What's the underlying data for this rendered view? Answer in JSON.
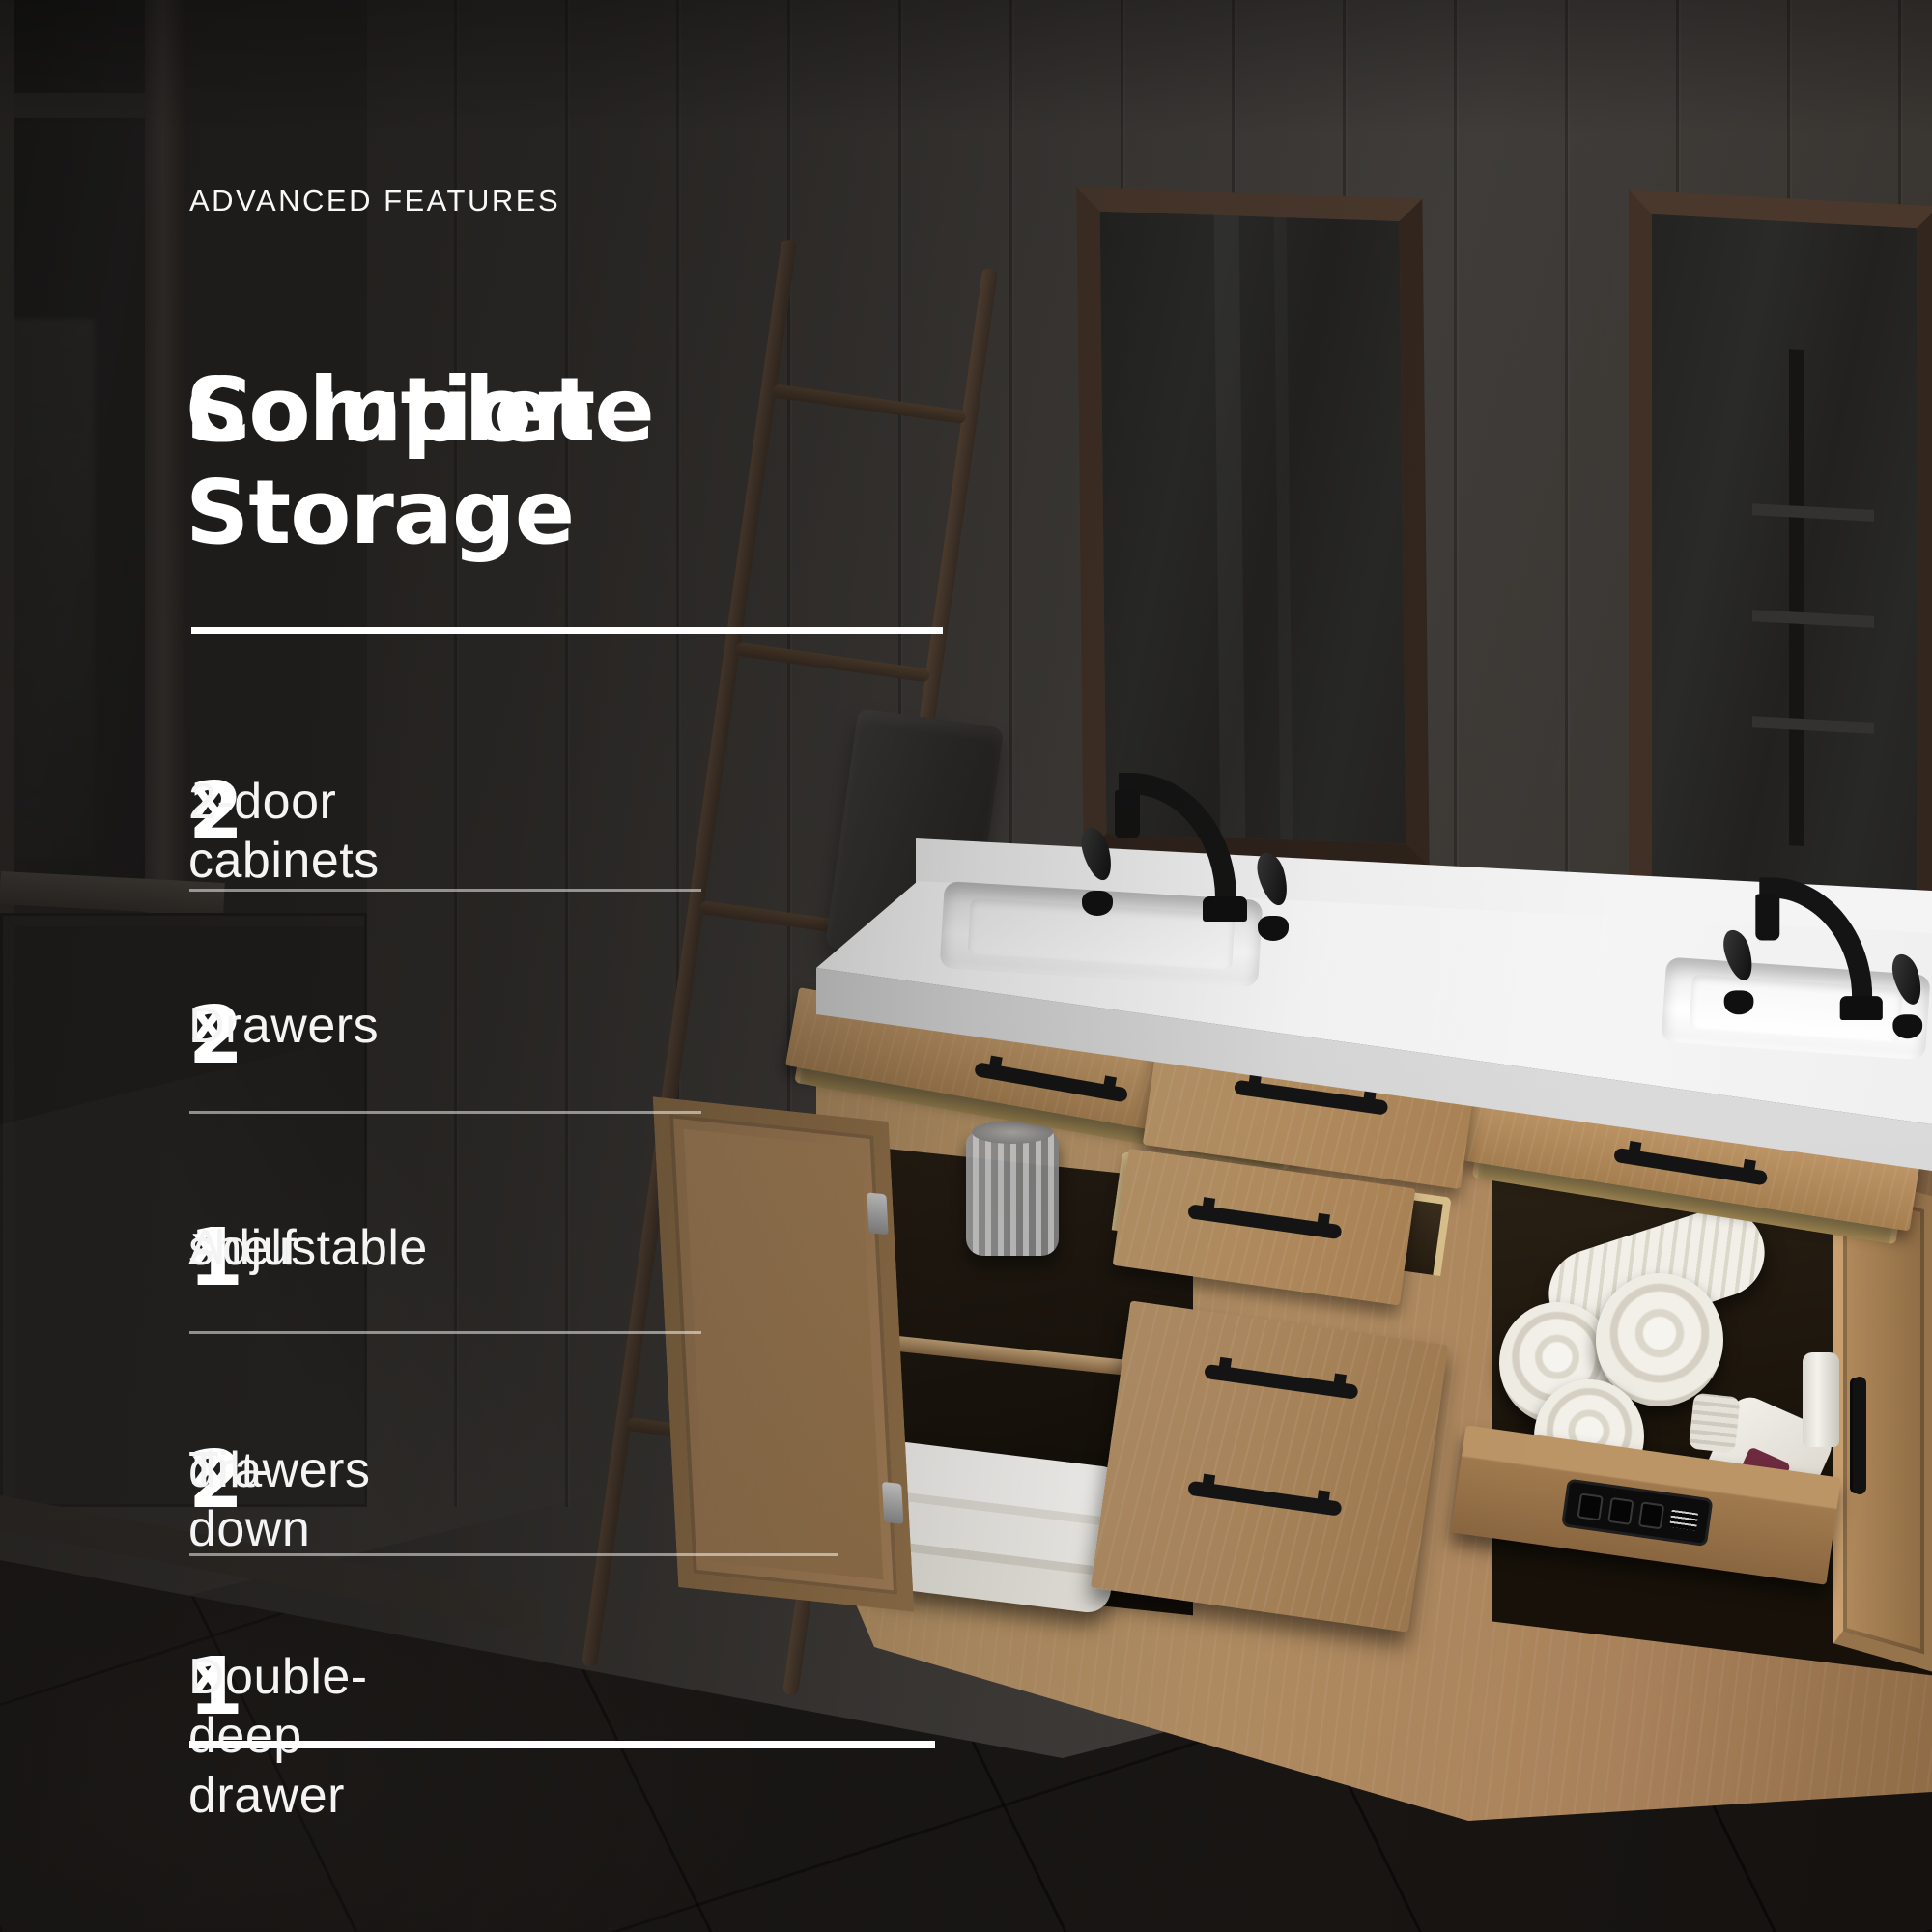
{
  "eyebrow": "ADVANCED FEATURES",
  "heading": {
    "line1": "Complete Storage",
    "line2": "Solution"
  },
  "features": [
    {
      "qty": "2",
      "times": "x",
      "line1": "2-door cabinets",
      "line2": ""
    },
    {
      "qty": "2",
      "times": "x",
      "line1": "Drawers",
      "line2": ""
    },
    {
      "qty": "1",
      "times": "x",
      "line1": "Adjustable",
      "line2": "shelf"
    },
    {
      "qty": "2",
      "times": "x",
      "line1": "Tilt-down",
      "line2": "drawers"
    },
    {
      "qty": "1",
      "times": "x",
      "line1": "Double-deep drawer",
      "line2": ""
    }
  ],
  "colors": {
    "text": "#ffffff",
    "divider_strong": "#ffffff",
    "divider_soft": "#8a8a8a",
    "wall": "#3b3835",
    "counter": "#ffffff",
    "oak_cabinet": "#b08a5c",
    "pine_tray": "#ecd9a4",
    "faucet_black": "#141414",
    "floor": "#1b1816",
    "mirror_frame": "#4a382c"
  }
}
